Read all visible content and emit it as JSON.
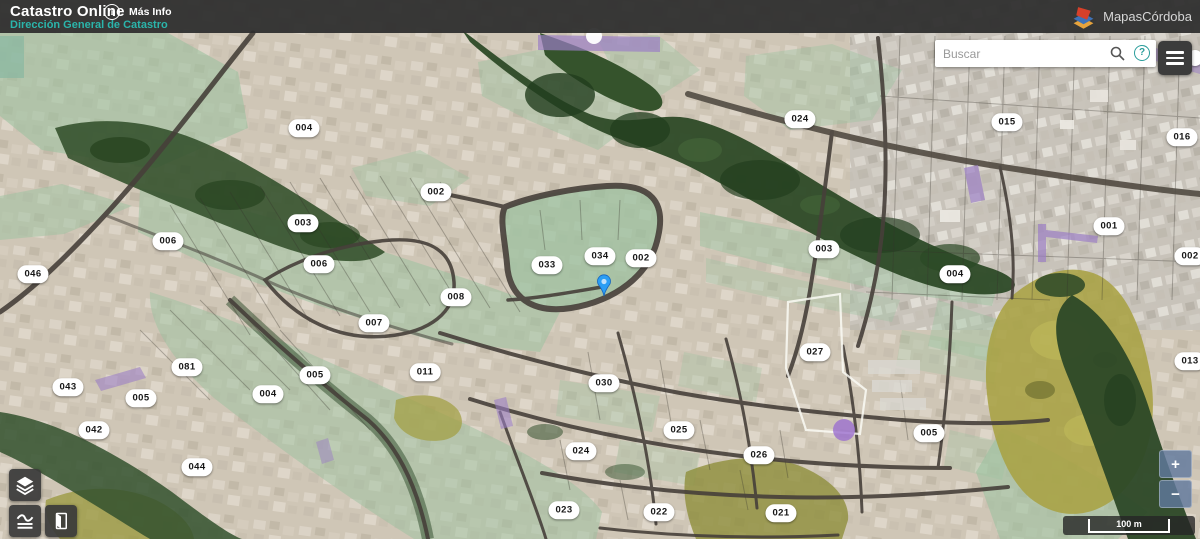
{
  "app": {
    "title": "Catastro Online",
    "info_glyph": "i",
    "more_info": "Más Info",
    "subtitle": "Dirección General de Catastro",
    "accent_color": "#2ab5ab",
    "header_color": "#2e2e2e"
  },
  "brand": {
    "name": "MapasCórdoba",
    "logo_colors": [
      "#d6402a",
      "#3e72b8",
      "#e6a33c"
    ]
  },
  "search": {
    "placeholder": "Buscar",
    "help_glyph": "?"
  },
  "icons": [
    "info-icon",
    "search-icon",
    "help-icon",
    "hamburger-menu-icon",
    "layers-icon",
    "basemap-swipe-icon",
    "map-sheet-icon",
    "layers-stack-logo-icon",
    "location-marker-icon"
  ],
  "map": {
    "marker": {
      "x": 604,
      "y": 297,
      "color": "#2a9df4"
    },
    "badges": [
      {
        "label": "004",
        "x": 304,
        "y": 128
      },
      {
        "label": "002",
        "x": 436,
        "y": 192
      },
      {
        "label": "003",
        "x": 303,
        "y": 223
      },
      {
        "label": "006",
        "x": 168,
        "y": 241
      },
      {
        "label": "006",
        "x": 319,
        "y": 264
      },
      {
        "label": "046",
        "x": 33,
        "y": 274
      },
      {
        "label": "033",
        "x": 547,
        "y": 265
      },
      {
        "label": "034",
        "x": 600,
        "y": 256
      },
      {
        "label": "002",
        "x": 641,
        "y": 258
      },
      {
        "label": "008",
        "x": 456,
        "y": 297
      },
      {
        "label": "024",
        "x": 800,
        "y": 119
      },
      {
        "label": "015",
        "x": 1007,
        "y": 122
      },
      {
        "label": "016",
        "x": 1182,
        "y": 137
      },
      {
        "label": "001",
        "x": 1109,
        "y": 226
      },
      {
        "label": "002",
        "x": 1190,
        "y": 256
      },
      {
        "label": "003",
        "x": 824,
        "y": 249
      },
      {
        "label": "004",
        "x": 955,
        "y": 274
      },
      {
        "label": "013",
        "x": 1190,
        "y": 361
      },
      {
        "label": "027",
        "x": 815,
        "y": 352
      },
      {
        "label": "007",
        "x": 374,
        "y": 323
      },
      {
        "label": "011",
        "x": 425,
        "y": 372
      },
      {
        "label": "081",
        "x": 187,
        "y": 367
      },
      {
        "label": "005",
        "x": 315,
        "y": 375
      },
      {
        "label": "043",
        "x": 68,
        "y": 387
      },
      {
        "label": "005",
        "x": 141,
        "y": 398
      },
      {
        "label": "004",
        "x": 268,
        "y": 394
      },
      {
        "label": "042",
        "x": 94,
        "y": 430
      },
      {
        "label": "044",
        "x": 197,
        "y": 467
      },
      {
        "label": "030",
        "x": 604,
        "y": 383
      },
      {
        "label": "025",
        "x": 679,
        "y": 430
      },
      {
        "label": "024",
        "x": 581,
        "y": 451
      },
      {
        "label": "026",
        "x": 759,
        "y": 455
      },
      {
        "label": "005",
        "x": 929,
        "y": 433
      },
      {
        "label": "023",
        "x": 564,
        "y": 510
      },
      {
        "label": "022",
        "x": 659,
        "y": 512
      },
      {
        "label": "021",
        "x": 781,
        "y": 513
      }
    ]
  },
  "controls": {
    "zoom_in": "+",
    "zoom_out": "−",
    "scale_label": "100 m"
  }
}
